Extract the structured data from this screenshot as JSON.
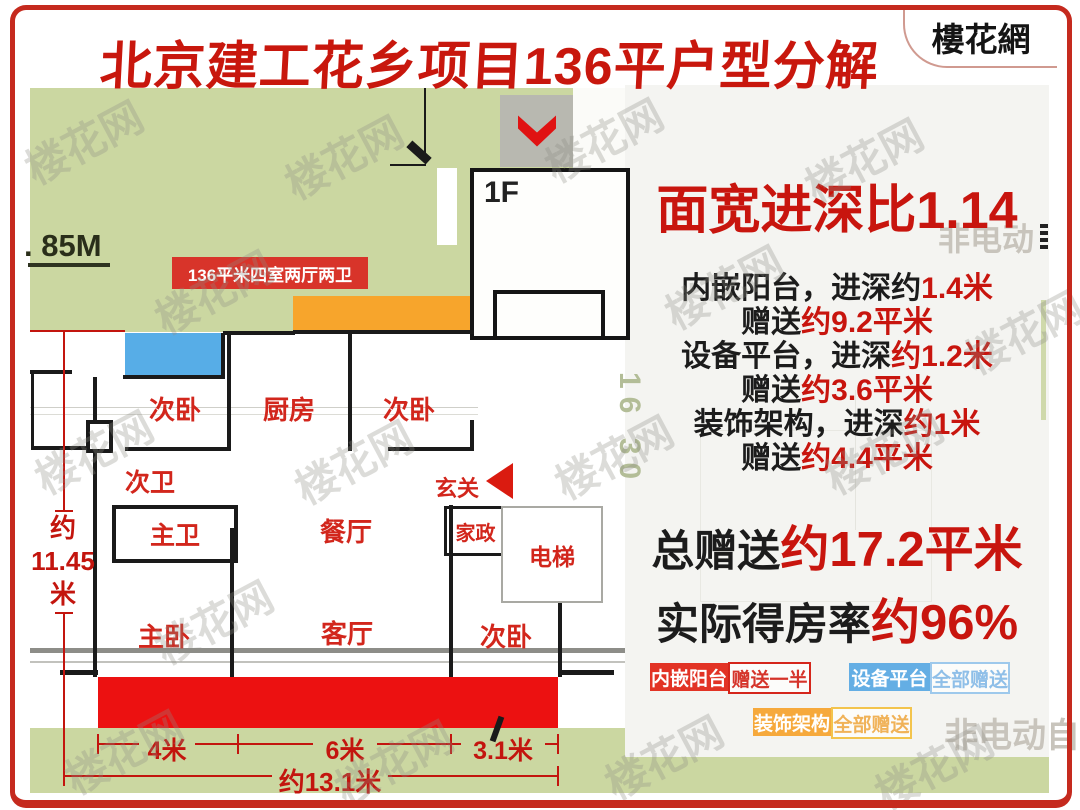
{
  "title": "北京建工花乡项目136平户型分解",
  "logo": "樓花網",
  "floor_plan": {
    "elevation_label": ". 85M",
    "unit_label": "136平米四室两厅两卫",
    "floor_label": "1F",
    "rooms": [
      {
        "label": "次卧"
      },
      {
        "label": "厨房"
      },
      {
        "label": "次卧"
      },
      {
        "label": "次卫"
      },
      {
        "label": "主卫"
      },
      {
        "label": "餐厅"
      },
      {
        "label": "玄关"
      },
      {
        "label": "家政"
      },
      {
        "label": "电梯"
      },
      {
        "label": "主卧"
      },
      {
        "label": "客厅"
      },
      {
        "label": "次卧"
      }
    ],
    "dims": {
      "seg1": "4米",
      "seg2": "6米",
      "seg3": "3.1米",
      "total_w": "约13.1米",
      "v1": "约",
      "v2": "11.45",
      "v3": "米"
    },
    "colors": {
      "balcony_red": "#ec1111",
      "equipment_blue": "#57ade7",
      "decor_orange": "#f7a52c",
      "plan_green": "#cbd7a1",
      "gray_box": "#b8b8b0"
    }
  },
  "info": {
    "ratio_title": "面宽进深比1.14",
    "lines": [
      {
        "black": "内嵌阳台，进深约",
        "red": "1.4米"
      },
      {
        "black": "赠送",
        "red": "约9.2平米"
      },
      {
        "black": "设备平台，进深",
        "red": "约1.2米"
      },
      {
        "black": "赠送",
        "red": "约3.6平米"
      },
      {
        "black": "装饰架构，进深",
        "red": "约1米"
      },
      {
        "black": "赠送",
        "red": "约4.4平米"
      }
    ],
    "total": {
      "black": "总赠送",
      "red": "约17.2平米"
    },
    "rate": {
      "black": "实际得房率",
      "red": "约96%"
    },
    "legend": [
      {
        "name": "内嵌阳台",
        "value": "赠送一半",
        "color": "#e23325"
      },
      {
        "name": "设备平台",
        "value": "全部赠送",
        "color": "#64aee4"
      },
      {
        "name": "装饰架构",
        "value": "全部赠送",
        "color": "#f6a93c"
      }
    ]
  },
  "background": {
    "watermark": "楼花网",
    "right_top_text": "非电动",
    "right_bottom_text": "非电动自",
    "vertical_text": "16 30"
  }
}
